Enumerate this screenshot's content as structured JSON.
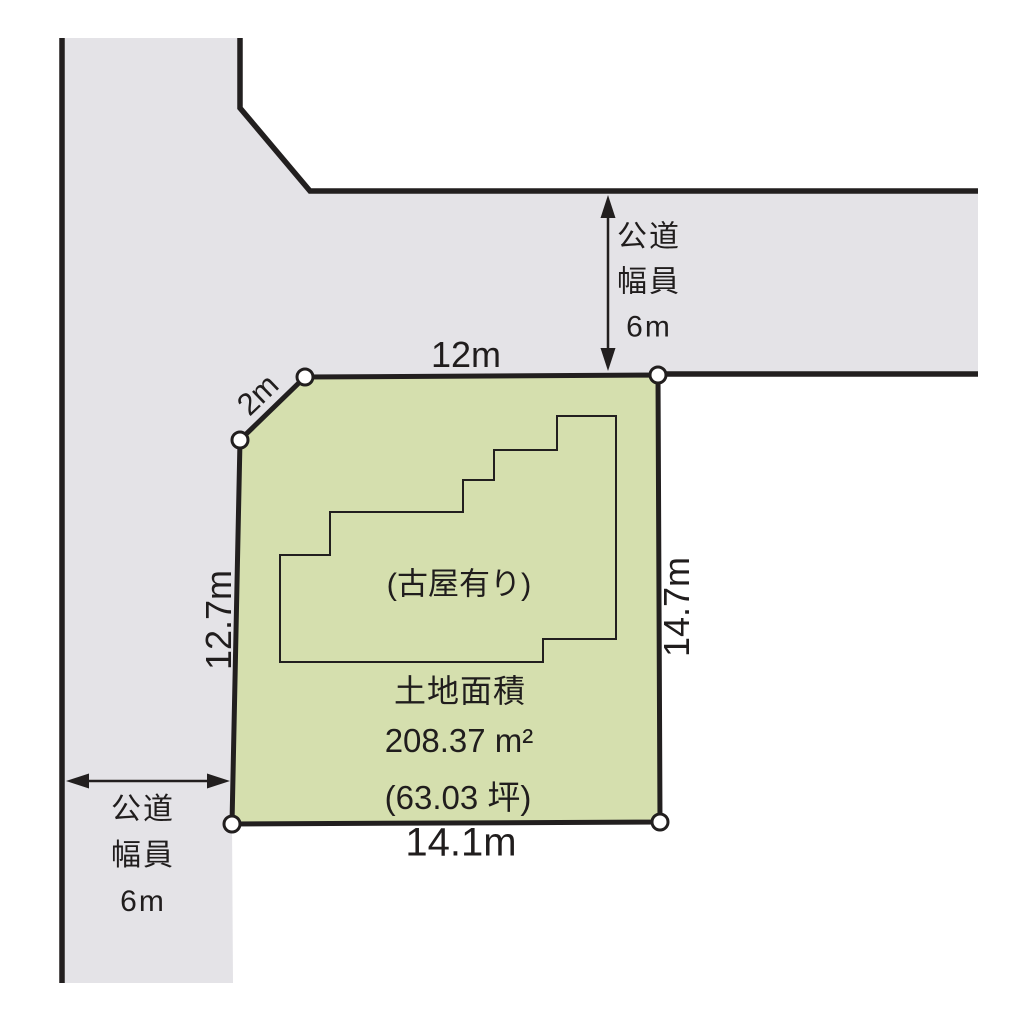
{
  "diagram": {
    "plot": {
      "dimensions": {
        "top": "12m",
        "corner_cut": "2m",
        "left": "12.7m",
        "right": "14.7m",
        "bottom": "14.1m"
      },
      "building_note": "(古屋有り)",
      "area": {
        "title": "土地面積",
        "square_meters": "208.37 m²",
        "tsubo": "(63.03 坪)"
      }
    },
    "road_note_top": {
      "lines": [
        "公道",
        "幅員",
        "6m"
      ]
    },
    "road_note_left": {
      "lines": [
        "公道",
        "幅員",
        "6m"
      ]
    },
    "colors": {
      "road_fill": "#e4e3e7",
      "plot_fill": "#d5dfae",
      "line": "#221f1f",
      "vertex_fill": "#ffffff"
    }
  }
}
